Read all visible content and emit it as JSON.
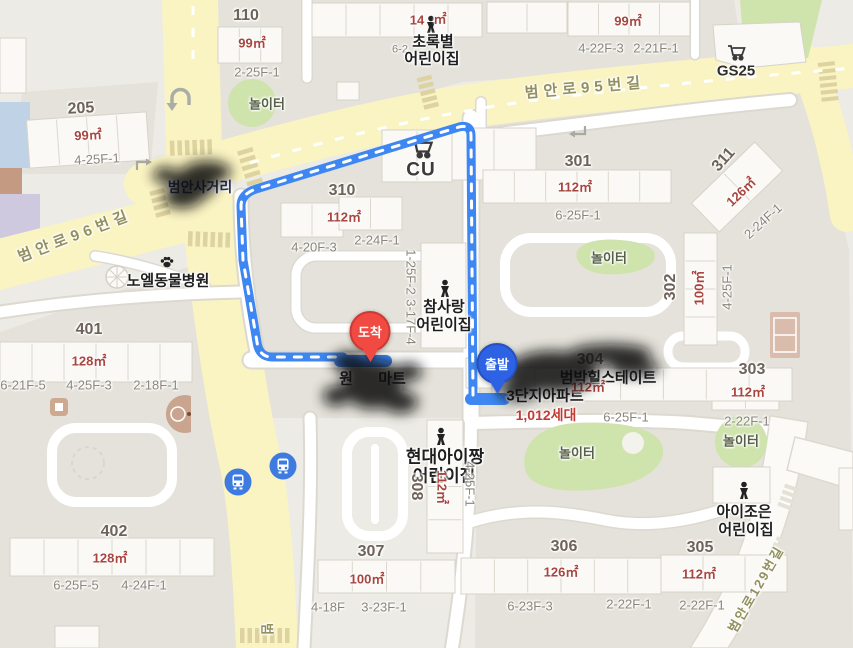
{
  "map": {
    "pins": {
      "start": {
        "label": "출발",
        "color": "#2d62e4"
      },
      "end": {
        "label": "도착",
        "color": "#f04a42"
      }
    },
    "colors": {
      "route_blue": "#3e87f2",
      "road_yellow": "#faf3c2",
      "playground_green": "#cfe3ac",
      "size_text_red": "#a8453f",
      "household_red": "#c13b35",
      "bus_icon_blue": "#3d7be0"
    },
    "icons": [
      "cart-icon",
      "bus-stop-icon",
      "paw-icon",
      "child-icon",
      "u-turn-icon",
      "turn-arrow-icon",
      "basketball-court-icon",
      "tennis-court-icon"
    ],
    "labels": [
      {
        "n": "block-110-number",
        "t": "110",
        "x": 246,
        "y": 16,
        "c": "num"
      },
      {
        "n": "block-110-size",
        "t": "99㎡",
        "x": 252,
        "y": 43,
        "c": "size"
      },
      {
        "n": "block-110-code",
        "t": "2-25F-1",
        "x": 257,
        "y": 72,
        "c": "code"
      },
      {
        "n": "playground-label-1",
        "t": "놀이터",
        "x": 267,
        "y": 104,
        "c": "pg"
      },
      {
        "n": "block-green-size-a",
        "t": "14",
        "x": 417,
        "y": 20,
        "c": "size"
      },
      {
        "n": "block-green-size-b",
        "t": "㎡",
        "x": 440,
        "y": 19,
        "c": "size"
      },
      {
        "n": "block-green-code",
        "t": "6-2",
        "x": 400,
        "y": 50,
        "c": "codesm"
      },
      {
        "n": "daycare-chorokbyeol-line1",
        "t": "초록별",
        "x": 433,
        "y": 42,
        "c": "poi",
        "i": true
      },
      {
        "n": "daycare-chorokbyeol-line2",
        "t": "어린이집",
        "x": 432,
        "y": 59,
        "c": "poi",
        "i": true
      },
      {
        "n": "block-topright-size",
        "t": "99㎡",
        "x": 628,
        "y": 21,
        "c": "size"
      },
      {
        "n": "block-topright-code-1",
        "t": "4-22F-3",
        "x": 601,
        "y": 48,
        "c": "code"
      },
      {
        "n": "block-topright-code-2",
        "t": "2-21F-1",
        "x": 656,
        "y": 48,
        "c": "code"
      },
      {
        "n": "gs25-label",
        "t": "GS25",
        "x": 736,
        "y": 71,
        "c": "store",
        "i": true
      },
      {
        "n": "road-beomanro95-label",
        "t": "범안로95번길",
        "x": 585,
        "y": 88,
        "c": "road",
        "r": -5
      },
      {
        "n": "block-205-number",
        "t": "205",
        "x": 81,
        "y": 109,
        "c": "num",
        "r": -3
      },
      {
        "n": "block-205-size",
        "t": "99㎡",
        "x": 88,
        "y": 135,
        "c": "size",
        "r": -3
      },
      {
        "n": "block-205-code",
        "t": "4-25F-1",
        "x": 97,
        "y": 159,
        "c": "code",
        "r": -3
      },
      {
        "n": "intersection-label",
        "t": "범안사거리",
        "x": 200,
        "y": 187,
        "c": "xing",
        "i": true
      },
      {
        "n": "road-beomanro96-label",
        "t": "범안로96번길",
        "x": 75,
        "y": 236,
        "c": "road",
        "r": -21
      },
      {
        "n": "animal-hospital-label",
        "t": "노엘동물병원",
        "x": 168,
        "y": 281,
        "c": "poi",
        "i": true
      },
      {
        "n": "block-401-number",
        "t": "401",
        "x": 89,
        "y": 330,
        "c": "num"
      },
      {
        "n": "block-401-size",
        "t": "128㎡",
        "x": 89,
        "y": 361,
        "c": "size"
      },
      {
        "n": "block-401-code-1",
        "t": "6-21F-5",
        "x": 23,
        "y": 385,
        "c": "code"
      },
      {
        "n": "block-401-code-2",
        "t": "4-25F-3",
        "x": 89,
        "y": 385,
        "c": "code"
      },
      {
        "n": "block-401-code-3",
        "t": "2-18F-1",
        "x": 156,
        "y": 385,
        "c": "code"
      },
      {
        "n": "cu-label",
        "t": "CU",
        "x": 421,
        "y": 170,
        "c": "storelg",
        "i": true
      },
      {
        "n": "block-310-number",
        "t": "310",
        "x": 342,
        "y": 191,
        "c": "num"
      },
      {
        "n": "block-310-size",
        "t": "112㎡",
        "x": 344,
        "y": 217,
        "c": "size"
      },
      {
        "n": "block-310-code-1",
        "t": "4-20F-3",
        "x": 314,
        "y": 247,
        "c": "code"
      },
      {
        "n": "block-310-code-2",
        "t": "2-24F-1",
        "x": 377,
        "y": 240,
        "c": "code"
      },
      {
        "n": "block-310-code-3",
        "t": "1-25F-2",
        "x": 411,
        "y": 272,
        "c": "code",
        "r": 90
      },
      {
        "n": "block-310-code-4",
        "t": "3-17F-4",
        "x": 411,
        "y": 322,
        "c": "code",
        "r": 90
      },
      {
        "n": "daycare-chamsarang-line1",
        "t": "참사랑",
        "x": 444,
        "y": 307,
        "c": "poi",
        "i": true
      },
      {
        "n": "daycare-chamsarang-line2",
        "t": "어린이집",
        "x": 444,
        "y": 325,
        "c": "poi",
        "i": true
      },
      {
        "n": "block-301-number",
        "t": "301",
        "x": 578,
        "y": 162,
        "c": "num"
      },
      {
        "n": "block-301-size",
        "t": "112㎡",
        "x": 575,
        "y": 187,
        "c": "size"
      },
      {
        "n": "block-301-code",
        "t": "6-25F-1",
        "x": 578,
        "y": 215,
        "c": "code"
      },
      {
        "n": "block-311-number",
        "t": "311",
        "x": 724,
        "y": 160,
        "c": "num",
        "r": -48
      },
      {
        "n": "block-311-size",
        "t": "126㎡",
        "x": 741,
        "y": 192,
        "c": "size",
        "r": -44
      },
      {
        "n": "block-311-code",
        "t": "2-24F-1",
        "x": 763,
        "y": 221,
        "c": "code",
        "r": -42
      },
      {
        "n": "playground-label-2",
        "t": "놀이터",
        "x": 609,
        "y": 258,
        "c": "pg"
      },
      {
        "n": "block-302-number",
        "t": "302",
        "x": 671,
        "y": 287,
        "c": "num",
        "r": -90
      },
      {
        "n": "block-302-size",
        "t": "100㎡",
        "x": 699,
        "y": 288,
        "c": "size",
        "r": -90
      },
      {
        "n": "block-302-code",
        "t": "4-25F-1",
        "x": 727,
        "y": 287,
        "c": "code",
        "r": -90
      },
      {
        "n": "block-303-number",
        "t": "303",
        "x": 752,
        "y": 370,
        "c": "num"
      },
      {
        "n": "block-303-size",
        "t": "112㎡",
        "x": 748,
        "y": 392,
        "c": "size"
      },
      {
        "n": "block-303-code",
        "t": "2-22F-1",
        "x": 747,
        "y": 421,
        "c": "code"
      },
      {
        "n": "playground-label-3",
        "t": "놀이터",
        "x": 741,
        "y": 441,
        "c": "pg"
      },
      {
        "n": "block-304-number",
        "t": "304",
        "x": 590,
        "y": 360,
        "c": "num"
      },
      {
        "n": "apartment-name-line1",
        "t": "범박힐스테이트",
        "x": 608,
        "y": 378,
        "c": "poi",
        "i": true
      },
      {
        "n": "apartment-name-line2",
        "t": "3단지아파트",
        "x": 545,
        "y": 396,
        "c": "poi",
        "i": true
      },
      {
        "n": "block-304-size",
        "t": "112㎡",
        "x": 588,
        "y": 387,
        "c": "size"
      },
      {
        "n": "household-count",
        "t": "1,012세대",
        "x": 546,
        "y": 415,
        "c": "red"
      },
      {
        "n": "block-304-code",
        "t": "6-25F-1",
        "x": 626,
        "y": 417,
        "c": "code"
      },
      {
        "n": "playground-label-4",
        "t": "놀이터",
        "x": 577,
        "y": 453,
        "c": "pg"
      },
      {
        "n": "mart-label-part1",
        "t": "원",
        "x": 346,
        "y": 379,
        "c": "poi",
        "i": true
      },
      {
        "n": "mart-label-part2",
        "t": "마트",
        "x": 392,
        "y": 379,
        "c": "poi",
        "i": true
      },
      {
        "n": "daycare-hyundai-line1",
        "t": "현대아이짱",
        "x": 445,
        "y": 457,
        "c": "poilg",
        "i": true
      },
      {
        "n": "daycare-hyundai-line2",
        "t": "어린이집",
        "x": 444,
        "y": 476,
        "c": "poilg",
        "i": true
      },
      {
        "n": "block-308-number",
        "t": "308",
        "x": 416,
        "y": 487,
        "c": "num",
        "r": 90
      },
      {
        "n": "block-308-size",
        "t": "112㎡",
        "x": 442,
        "y": 487,
        "c": "size",
        "r": 90
      },
      {
        "n": "block-308-code",
        "t": "4-25F-1",
        "x": 470,
        "y": 484,
        "c": "code",
        "r": 90
      },
      {
        "n": "block-307-number",
        "t": "307",
        "x": 371,
        "y": 552,
        "c": "num"
      },
      {
        "n": "block-307-size",
        "t": "100㎡",
        "x": 367,
        "y": 579,
        "c": "size"
      },
      {
        "n": "block-307-code-1",
        "t": "4-18F",
        "x": 328,
        "y": 607,
        "c": "code"
      },
      {
        "n": "block-307-code-2",
        "t": "3-23F-1",
        "x": 384,
        "y": 607,
        "c": "code"
      },
      {
        "n": "block-306-number",
        "t": "306",
        "x": 564,
        "y": 547,
        "c": "num"
      },
      {
        "n": "block-306-size",
        "t": "126㎡",
        "x": 561,
        "y": 572,
        "c": "size"
      },
      {
        "n": "block-306-code-1",
        "t": "6-23F-3",
        "x": 530,
        "y": 606,
        "c": "code"
      },
      {
        "n": "block-306-code-2",
        "t": "2-22F-1",
        "x": 629,
        "y": 604,
        "c": "code"
      },
      {
        "n": "block-305-number",
        "t": "305",
        "x": 700,
        "y": 548,
        "c": "num"
      },
      {
        "n": "block-305-size",
        "t": "112㎡",
        "x": 699,
        "y": 574,
        "c": "size"
      },
      {
        "n": "block-305-code",
        "t": "2-22F-1",
        "x": 702,
        "y": 605,
        "c": "code"
      },
      {
        "n": "daycare-aijoeun-line1",
        "t": "아이조은",
        "x": 744,
        "y": 512,
        "c": "poi",
        "i": true
      },
      {
        "n": "daycare-aijoeun-line2",
        "t": "어린이집",
        "x": 746,
        "y": 530,
        "c": "poi",
        "i": true
      },
      {
        "n": "block-402-number",
        "t": "402",
        "x": 114,
        "y": 532,
        "c": "num"
      },
      {
        "n": "block-402-size",
        "t": "128㎡",
        "x": 110,
        "y": 558,
        "c": "size"
      },
      {
        "n": "block-402-code-1",
        "t": "6-25F-5",
        "x": 76,
        "y": 585,
        "c": "code"
      },
      {
        "n": "block-402-code-2",
        "t": "4-24F-1",
        "x": 144,
        "y": 585,
        "c": "code"
      },
      {
        "n": "road-beomanro129-label",
        "t": "범안로129번길",
        "x": 756,
        "y": 589,
        "c": "roadsm",
        "r": -60
      },
      {
        "n": "road-bottom-label",
        "t": "범",
        "x": 267,
        "y": 630,
        "c": "roadsm",
        "r": 90
      }
    ]
  }
}
